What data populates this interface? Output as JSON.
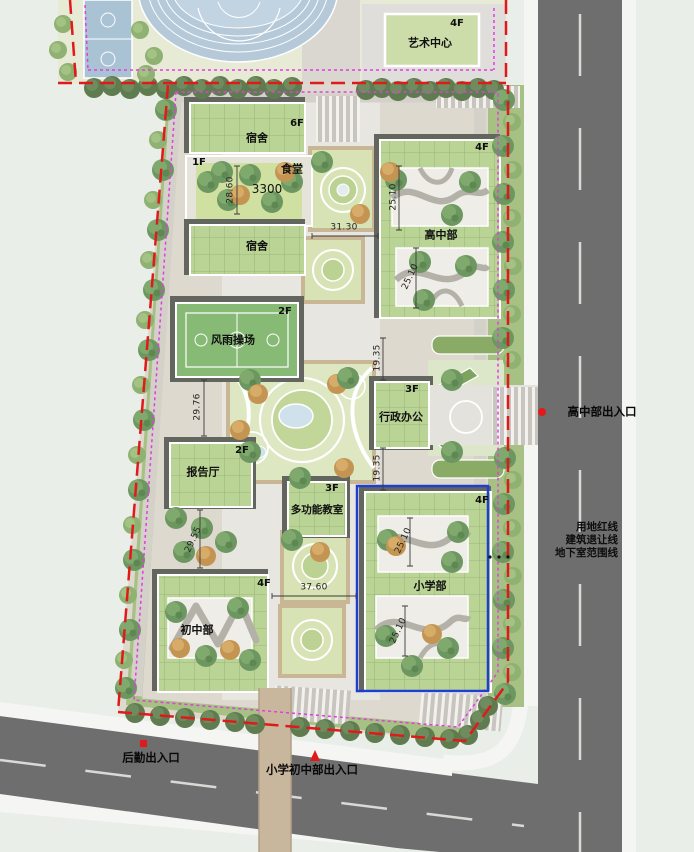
{
  "title": "学校校园总平面图",
  "buildings": [
    {
      "id": "art-center",
      "label": "艺术中心",
      "floors": "4F"
    },
    {
      "id": "dormitory-1",
      "label": "宿舍",
      "floors": "6F"
    },
    {
      "id": "canteen",
      "label": "食堂",
      "floors": "1F",
      "area": "3300"
    },
    {
      "id": "dormitory-2",
      "label": "宿舍"
    },
    {
      "id": "high-school",
      "label": "高中部",
      "floors": "4F"
    },
    {
      "id": "sports-hall",
      "label": "风雨操场",
      "floors": "2F"
    },
    {
      "id": "admin-office",
      "label": "行政办公",
      "floors": "3F"
    },
    {
      "id": "lecture-hall",
      "label": "报告厅",
      "floors": "2F"
    },
    {
      "id": "multi-classroom",
      "label": "多功能教室",
      "floors": "3F"
    },
    {
      "id": "primary-school",
      "label": "小学部",
      "floors": "4F"
    },
    {
      "id": "middle-school",
      "label": "初中部",
      "floors": "4F"
    }
  ],
  "dims": {
    "k2860": "28.60",
    "k3130": "31.30",
    "k2510": "25.10",
    "k1935": "19.35",
    "k2976": "29.76",
    "k2955": "29.55",
    "k3760": "37.60",
    "area3300": "3300"
  },
  "entrances": {
    "east": "高中部出入口",
    "logistics": "后勤出入口",
    "south": "小学初中部出入口"
  },
  "legend": {
    "red": "用地红线",
    "setback": "建筑退让线",
    "basement": "地下室范围线"
  },
  "colors": {
    "boundary_red": "#e01a1a",
    "setback_magenta": "#e23ce2",
    "basement_blue": "#1f3fd0",
    "building_green": "#b9d494",
    "road_gray": "#6e6e6e"
  }
}
